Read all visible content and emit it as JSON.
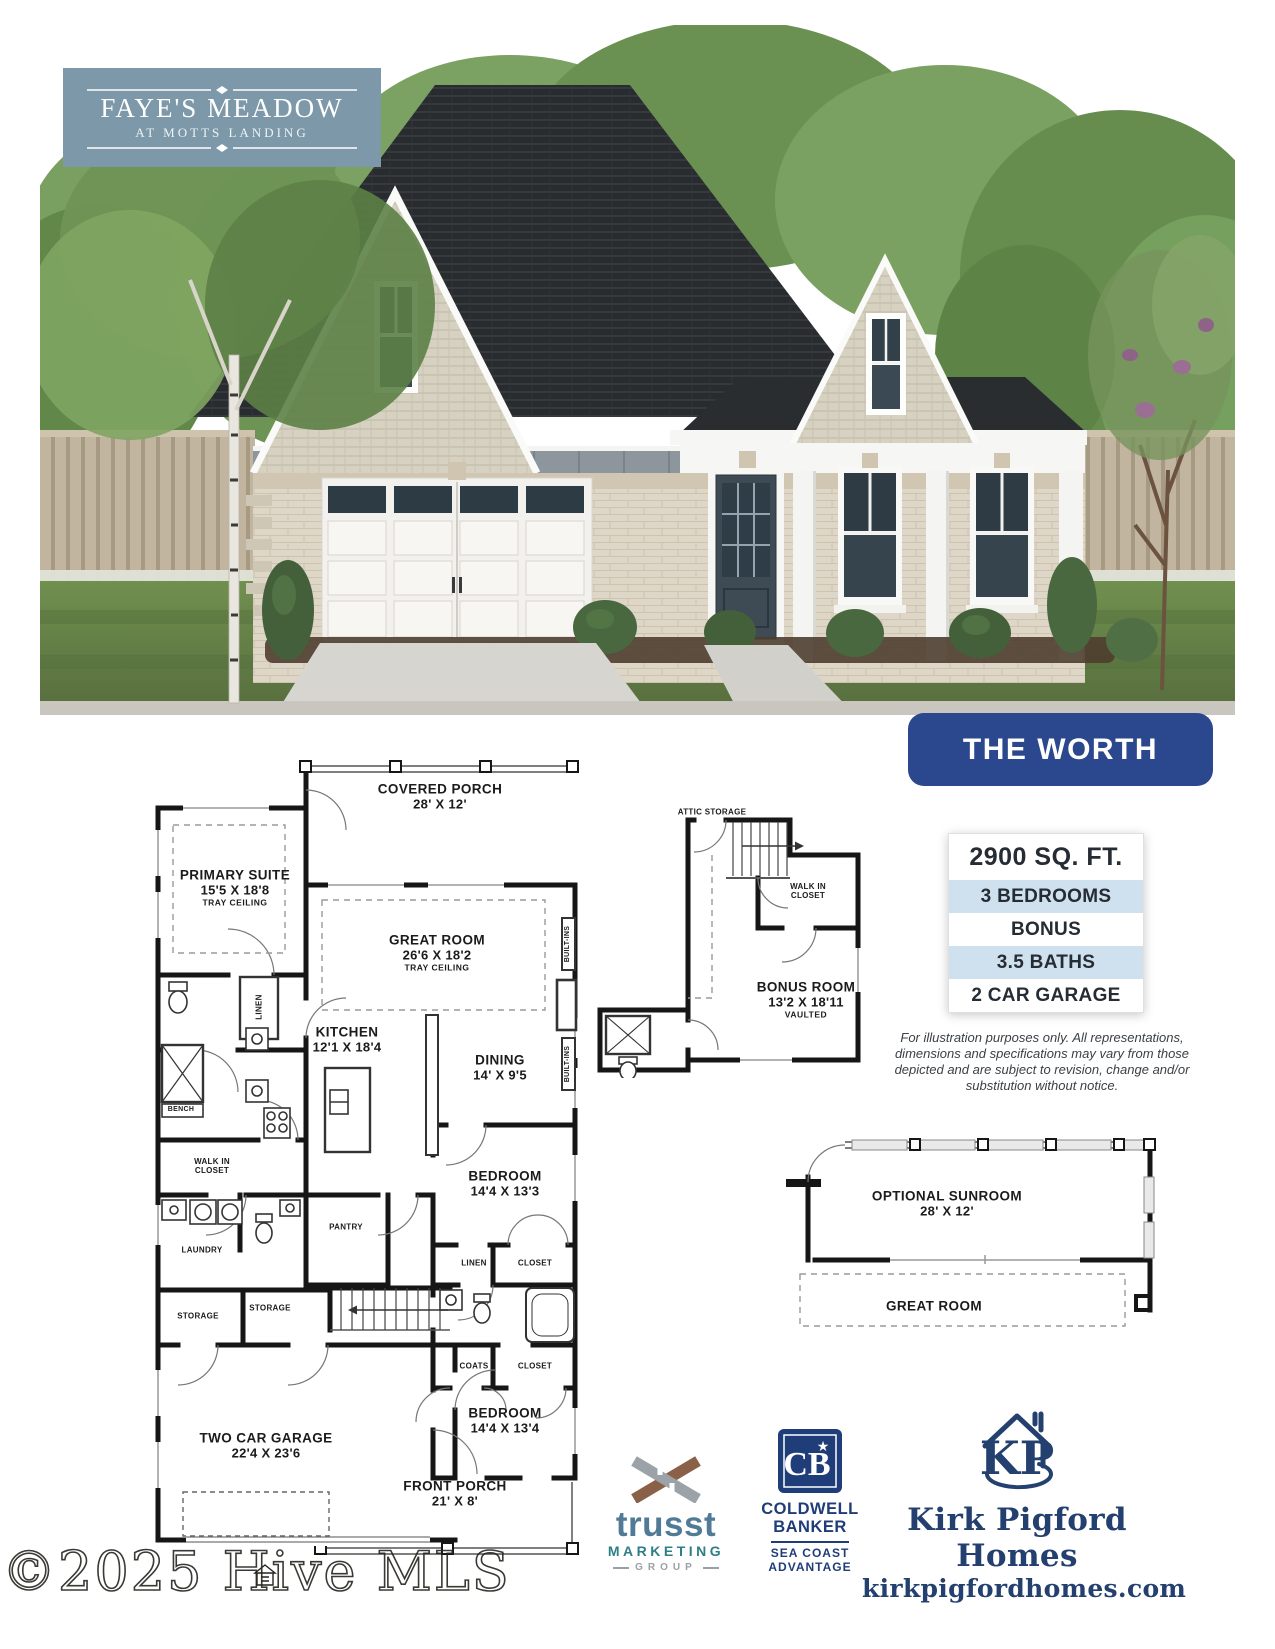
{
  "colors": {
    "badge_bg": "#7d98a9",
    "banner_bg": "#2b478e",
    "spec_blue": "#cfe1ee",
    "plan_ink": "#1b1b1b",
    "trusst_blue": "#507a95",
    "trusst_teal": "#2e7e88",
    "coldwell_navy": "#1f3d78",
    "builder_navy": "#24406f"
  },
  "badge": {
    "title": "FAYE'S MEADOW",
    "subtitle": "AT MOTTS LANDING"
  },
  "plan_banner": "THE WORTH",
  "specs": {
    "sqft": "2900 SQ. FT.",
    "items": [
      "3 BEDROOMS",
      "BONUS",
      "3.5 BATHS",
      "2 CAR GARAGE"
    ]
  },
  "disclaimer": "For illustration purposes only.  All representations, dimensions and specifications may vary from those depicted and are subject to revision, change and/or substitution without notice.",
  "main_plan": {
    "rooms": {
      "covered_porch": {
        "name": "COVERED PORCH",
        "dims": "28' X 12'"
      },
      "primary": {
        "name": "PRIMARY SUITE",
        "dims": "15'5 X 18'8",
        "note": "TRAY CEILING"
      },
      "great": {
        "name": "GREAT ROOM",
        "dims": "26'6 X 18'2",
        "note": "TRAY CEILING"
      },
      "kitchen": {
        "name": "KITCHEN",
        "dims": "12'1 X 18'4"
      },
      "dining": {
        "name": "DINING",
        "dims": "14' X 9'5"
      },
      "bedroom1": {
        "name": "BEDROOM",
        "dims": "14'4 X 13'3"
      },
      "bedroom2": {
        "name": "BEDROOM",
        "dims": "14'4 X 13'4"
      },
      "garage": {
        "name": "TWO CAR GARAGE",
        "dims": "22'4 X 23'6"
      },
      "front_porch": {
        "name": "FRONT PORCH",
        "dims": "21' X 8'"
      }
    },
    "small": {
      "linen": "LINEN",
      "bench": "BENCH",
      "wic": "WALK IN CLOSET",
      "laundry": "LAUNDRY",
      "pantry": "PANTRY",
      "storage1": "STORAGE",
      "storage2": "STORAGE",
      "linen2": "LINEN",
      "closet1": "CLOSET",
      "coats": "COATS",
      "closet2": "CLOSET",
      "builtins": "BUILT-INS"
    }
  },
  "bonus_plan": {
    "attic": "ATTIC STORAGE",
    "wic": "WALK IN CLOSET",
    "room": {
      "name": "BONUS ROOM",
      "dims": "13'2 X 18'11",
      "note": "VAULTED"
    }
  },
  "sunroom_plan": {
    "room": {
      "name": "OPTIONAL SUNROOM",
      "dims": "28' X 12'"
    },
    "below": "GREAT ROOM"
  },
  "logos": {
    "trusst": {
      "name": "trusst",
      "line2": "MARKETING",
      "line3": "GROUP"
    },
    "coldwell": {
      "monogram": "CB",
      "star": "★",
      "line1": "COLDWELL",
      "line2": "BANKER",
      "line3": "SEA COAST",
      "line4": "ADVANTAGE"
    },
    "builder": {
      "monogram": "KP",
      "name": "Kirk Pigford Homes",
      "website": "kirkpigfordhomes.com"
    }
  },
  "watermark": "©2025 Hive MLS"
}
